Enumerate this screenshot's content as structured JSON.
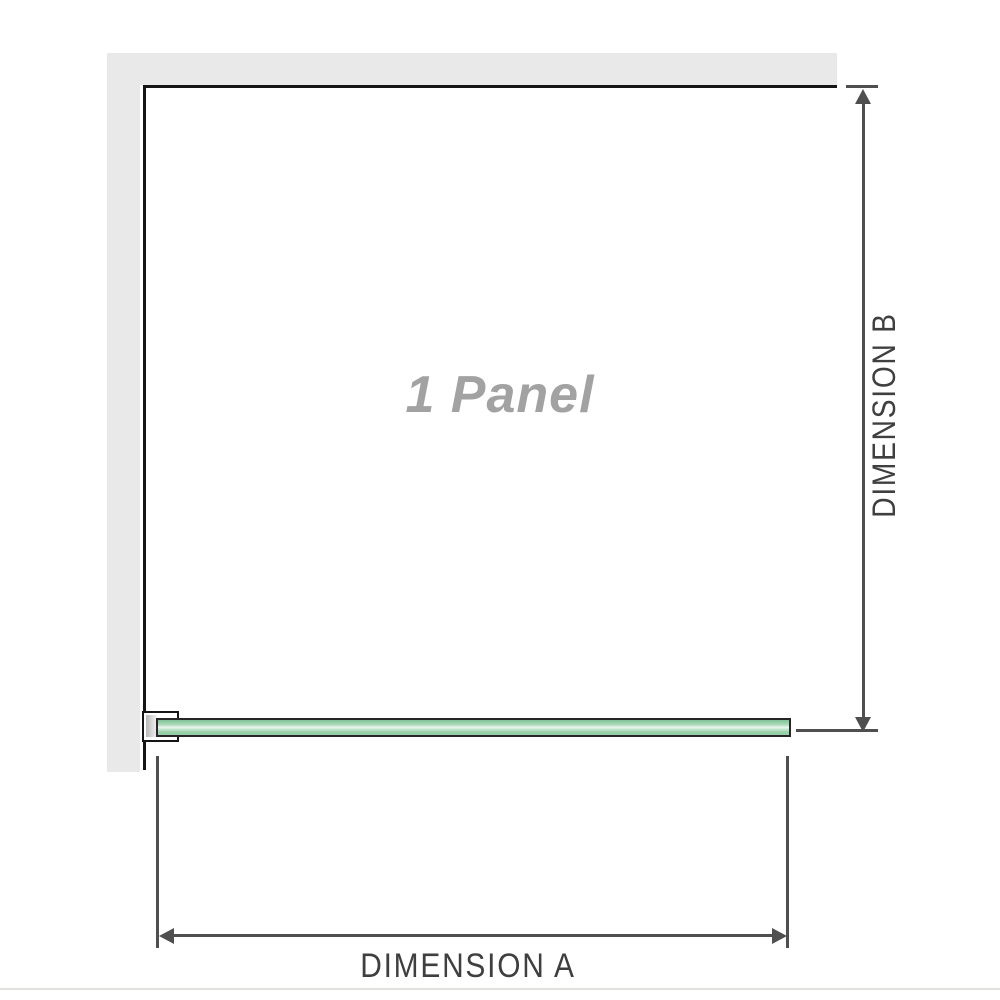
{
  "diagram": {
    "title": "1 Panel",
    "dimension_a": "DIMENSION A",
    "dimension_b": "DIMENSION B"
  },
  "colors": {
    "wall": "#e9e9e9",
    "panel_border": "#151515",
    "glass_outline": "#262626",
    "glass_top": "#82c298",
    "glass_highlight": "#edf7f0",
    "glass_bottom": "#97cfa8",
    "dimension": "#4f4f4f",
    "label": "#3f3f3f",
    "panel_title": "#a2a2a2",
    "rule": "#e2e1de"
  }
}
